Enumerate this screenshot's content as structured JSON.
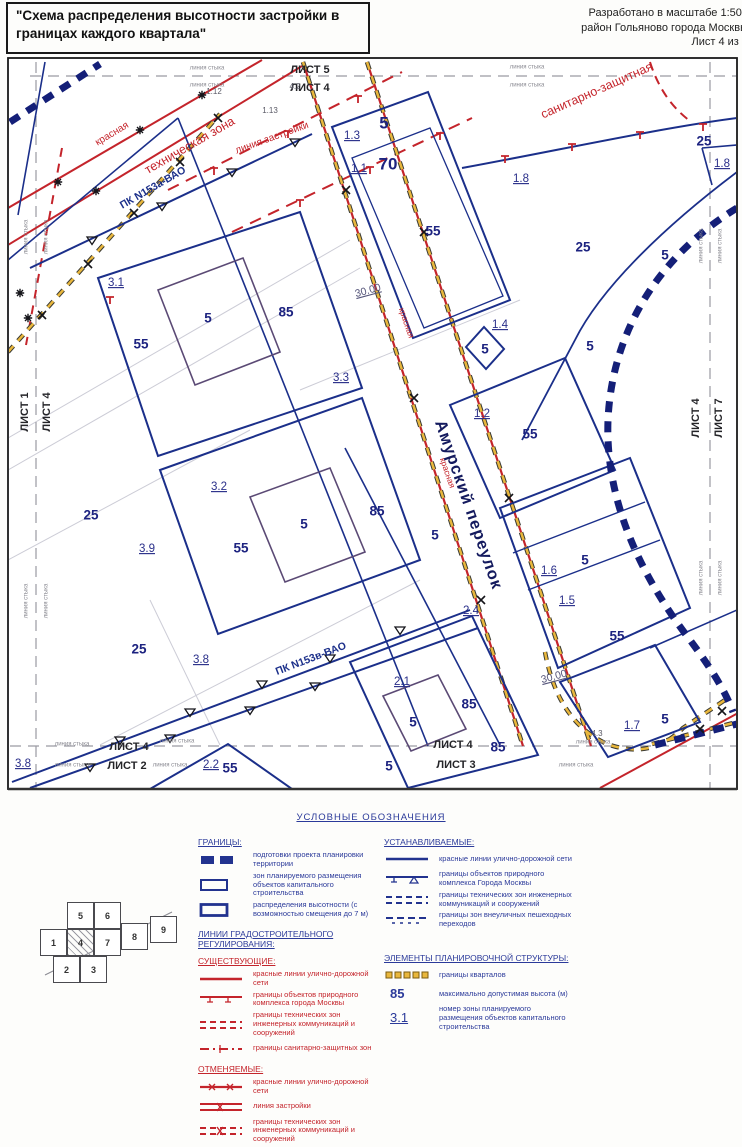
{
  "header": {
    "title": "\"Схема распределения высотности застройки в границах каждого квартала\"",
    "right_lines": [
      "Разработано в масштабе 1:500",
      "район Гольяново города Москвы",
      "Лист 4 из 9"
    ]
  },
  "map": {
    "labels": [
      {
        "t": "ЛИСТ 5",
        "x": 310,
        "y": 70,
        "c": "s"
      },
      {
        "t": "ЛИСТ 4",
        "x": 310,
        "y": 88,
        "c": "s"
      },
      {
        "t": "линия стыка",
        "x": 207,
        "y": 68,
        "c": "ss"
      },
      {
        "t": "линия стыка",
        "x": 207,
        "y": 85,
        "c": "ss"
      },
      {
        "t": "линия стыка",
        "x": 527,
        "y": 67,
        "c": "ss"
      },
      {
        "t": "линия стыка",
        "x": 527,
        "y": 85,
        "c": "ss"
      },
      {
        "t": "1.12",
        "x": 214,
        "y": 92,
        "c": "zs"
      },
      {
        "t": "4.2",
        "x": 295,
        "y": 87,
        "c": "zs"
      },
      {
        "t": "1.13",
        "x": 270,
        "y": 111,
        "c": "zs"
      },
      {
        "t": "ЛИСТ 1",
        "x": 25,
        "y": 412,
        "r": -90,
        "c": "s"
      },
      {
        "t": "ЛИСТ 4",
        "x": 47,
        "y": 412,
        "r": -90,
        "c": "s"
      },
      {
        "t": "линия стыка",
        "x": 26,
        "y": 237,
        "r": -90,
        "c": "ss"
      },
      {
        "t": "линия стыка",
        "x": 46,
        "y": 237,
        "r": -90,
        "c": "ss"
      },
      {
        "t": "линия стыка",
        "x": 26,
        "y": 601,
        "r": -90,
        "c": "ss"
      },
      {
        "t": "линия стыка",
        "x": 46,
        "y": 601,
        "r": -90,
        "c": "ss"
      },
      {
        "t": "ЛИСТ 4",
        "x": 696,
        "y": 418,
        "r": -90,
        "c": "s"
      },
      {
        "t": "ЛИСТ 7",
        "x": 719,
        "y": 418,
        "r": -90,
        "c": "s"
      },
      {
        "t": "линия стыка",
        "x": 701,
        "y": 246,
        "r": -90,
        "c": "ss"
      },
      {
        "t": "линия стыка",
        "x": 720,
        "y": 246,
        "r": -90,
        "c": "ss"
      },
      {
        "t": "линия стыка",
        "x": 701,
        "y": 578,
        "r": -90,
        "c": "ss"
      },
      {
        "t": "линия стыка",
        "x": 720,
        "y": 578,
        "r": -90,
        "c": "ss"
      },
      {
        "t": "ЛИСТ 4",
        "x": 129,
        "y": 747,
        "c": "s"
      },
      {
        "t": "ЛИСТ 2",
        "x": 127,
        "y": 766,
        "c": "s"
      },
      {
        "t": "линия стыка",
        "x": 72,
        "y": 744,
        "c": "ss"
      },
      {
        "t": "линия стыка",
        "x": 72,
        "y": 765,
        "c": "ss"
      },
      {
        "t": "линия стыка",
        "x": 177,
        "y": 741,
        "c": "ss"
      },
      {
        "t": "линия стыка",
        "x": 170,
        "y": 765,
        "c": "ss"
      },
      {
        "t": "ЛИСТ 4",
        "x": 453,
        "y": 745,
        "c": "s"
      },
      {
        "t": "ЛИСТ 3",
        "x": 456,
        "y": 765,
        "c": "s"
      },
      {
        "t": "линия стыка",
        "x": 593,
        "y": 742,
        "c": "ss"
      },
      {
        "t": "линия стыка",
        "x": 576,
        "y": 765,
        "c": "ss"
      },
      {
        "t": "1.3",
        "x": 352,
        "y": 136,
        "c": "z"
      },
      {
        "t": "5",
        "x": 384,
        "y": 124,
        "c": "hl"
      },
      {
        "t": "1.1",
        "x": 359,
        "y": 169,
        "c": "z"
      },
      {
        "t": "70",
        "x": 388,
        "y": 165,
        "c": "hl"
      },
      {
        "t": "55",
        "x": 433,
        "y": 232,
        "c": "h"
      },
      {
        "t": "1.8",
        "x": 521,
        "y": 179,
        "c": "z"
      },
      {
        "t": "25",
        "x": 583,
        "y": 248,
        "c": "h"
      },
      {
        "t": "25",
        "x": 704,
        "y": 142,
        "c": "h"
      },
      {
        "t": "1.8",
        "x": 722,
        "y": 164,
        "c": "z"
      },
      {
        "t": "5",
        "x": 665,
        "y": 256,
        "c": "h"
      },
      {
        "t": "1.4",
        "x": 500,
        "y": 325,
        "c": "z"
      },
      {
        "t": "5",
        "x": 485,
        "y": 350,
        "c": "h"
      },
      {
        "t": "5",
        "x": 590,
        "y": 347,
        "c": "h"
      },
      {
        "t": "1.2",
        "x": 482,
        "y": 414,
        "c": "z"
      },
      {
        "t": "55",
        "x": 530,
        "y": 435,
        "c": "h"
      },
      {
        "t": "3.1",
        "x": 116,
        "y": 283,
        "c": "z"
      },
      {
        "t": "55",
        "x": 141,
        "y": 345,
        "c": "h"
      },
      {
        "t": "5",
        "x": 208,
        "y": 319,
        "c": "h"
      },
      {
        "t": "85",
        "x": 286,
        "y": 313,
        "c": "h"
      },
      {
        "t": "3.3",
        "x": 341,
        "y": 378,
        "c": "z"
      },
      {
        "t": "30.00",
        "x": 368,
        "y": 291,
        "r": -15,
        "c": "d"
      },
      {
        "t": "25",
        "x": 91,
        "y": 516,
        "c": "h"
      },
      {
        "t": "3.2",
        "x": 219,
        "y": 487,
        "c": "z"
      },
      {
        "t": "55",
        "x": 241,
        "y": 549,
        "c": "h"
      },
      {
        "t": "5",
        "x": 304,
        "y": 525,
        "c": "h"
      },
      {
        "t": "85",
        "x": 377,
        "y": 512,
        "c": "h"
      },
      {
        "t": "3.9",
        "x": 147,
        "y": 549,
        "c": "z"
      },
      {
        "t": "25",
        "x": 139,
        "y": 650,
        "c": "h"
      },
      {
        "t": "3.8",
        "x": 201,
        "y": 660,
        "c": "z"
      },
      {
        "t": "5",
        "x": 435,
        "y": 536,
        "c": "h"
      },
      {
        "t": "2.4",
        "x": 471,
        "y": 611,
        "c": "z"
      },
      {
        "t": "1.6",
        "x": 549,
        "y": 571,
        "c": "z"
      },
      {
        "t": "5",
        "x": 585,
        "y": 561,
        "c": "h"
      },
      {
        "t": "1.5",
        "x": 567,
        "y": 601,
        "c": "z"
      },
      {
        "t": "55",
        "x": 617,
        "y": 637,
        "c": "h"
      },
      {
        "t": "30.00",
        "x": 554,
        "y": 677,
        "r": -15,
        "c": "d"
      },
      {
        "t": "2.1",
        "x": 402,
        "y": 682,
        "c": "z"
      },
      {
        "t": "5",
        "x": 413,
        "y": 723,
        "c": "h"
      },
      {
        "t": "85",
        "x": 469,
        "y": 705,
        "c": "h"
      },
      {
        "t": "85",
        "x": 498,
        "y": 748,
        "c": "h"
      },
      {
        "t": "1.7",
        "x": 632,
        "y": 726,
        "c": "z"
      },
      {
        "t": "5",
        "x": 665,
        "y": 720,
        "c": "h"
      },
      {
        "t": "4.3",
        "x": 597,
        "y": 734,
        "c": "zs"
      },
      {
        "t": "2.2",
        "x": 211,
        "y": 765,
        "c": "z"
      },
      {
        "t": "55",
        "x": 230,
        "y": 769,
        "c": "h"
      },
      {
        "t": "5",
        "x": 389,
        "y": 767,
        "c": "h"
      },
      {
        "t": "3.8",
        "x": 23,
        "y": 764,
        "c": "z"
      },
      {
        "t": "красная",
        "x": 112,
        "y": 134,
        "r": -31,
        "c": "r"
      },
      {
        "t": "техническая зона",
        "x": 190,
        "y": 146,
        "r": -30,
        "c": "rl"
      },
      {
        "t": "линия застройки",
        "x": 272,
        "y": 138,
        "r": -20,
        "c": "r"
      },
      {
        "t": "санитарно-защитная",
        "x": 597,
        "y": 91,
        "r": -24,
        "c": "rl"
      },
      {
        "t": "ПК N153а-ВАО",
        "x": 153,
        "y": 188,
        "r": -30,
        "c": "n"
      },
      {
        "t": "ПК N153в-ВАО",
        "x": 311,
        "y": 659,
        "r": -21,
        "c": "n"
      },
      {
        "t": "красная",
        "x": 406,
        "y": 323,
        "r": 71,
        "c": "rs"
      },
      {
        "t": "красная",
        "x": 447,
        "y": 473,
        "r": 71,
        "c": "rs"
      },
      {
        "t": "Амурский переулок",
        "x": 468,
        "y": 505,
        "r": 71,
        "c": "st"
      }
    ],
    "markers": [
      {
        "t": "x",
        "x": 42,
        "y": 315
      },
      {
        "t": "x",
        "x": 88,
        "y": 264
      },
      {
        "t": "x",
        "x": 134,
        "y": 213
      },
      {
        "t": "x",
        "x": 180,
        "y": 162
      },
      {
        "t": "x",
        "x": 218,
        "y": 118
      },
      {
        "t": "x",
        "x": 346,
        "y": 190
      },
      {
        "t": "x",
        "x": 414,
        "y": 398
      },
      {
        "t": "x",
        "x": 481,
        "y": 600
      },
      {
        "t": "x",
        "x": 424,
        "y": 232
      },
      {
        "t": "x",
        "x": 509,
        "y": 498
      },
      {
        "t": "x",
        "x": 700,
        "y": 729
      },
      {
        "t": "x",
        "x": 722,
        "y": 711
      },
      {
        "t": "star",
        "x": 58,
        "y": 182
      },
      {
        "t": "star",
        "x": 140,
        "y": 130
      },
      {
        "t": "star",
        "x": 202,
        "y": 95
      },
      {
        "t": "star",
        "x": 96,
        "y": 191
      },
      {
        "t": "star",
        "x": 20,
        "y": 293
      },
      {
        "t": "star",
        "x": 28,
        "y": 318
      },
      {
        "t": "tri",
        "x": 92,
        "y": 240
      },
      {
        "t": "tri",
        "x": 162,
        "y": 206
      },
      {
        "t": "tri",
        "x": 232,
        "y": 172
      },
      {
        "t": "tri",
        "x": 295,
        "y": 142
      },
      {
        "t": "tri",
        "x": 120,
        "y": 740
      },
      {
        "t": "tri",
        "x": 190,
        "y": 712
      },
      {
        "t": "tri",
        "x": 262,
        "y": 684
      },
      {
        "t": "tri",
        "x": 330,
        "y": 658
      },
      {
        "t": "tri",
        "x": 400,
        "y": 630
      },
      {
        "t": "tri",
        "x": 90,
        "y": 767
      },
      {
        "t": "tri",
        "x": 170,
        "y": 738
      },
      {
        "t": "tri",
        "x": 250,
        "y": 710
      },
      {
        "t": "tri",
        "x": 315,
        "y": 686
      },
      {
        "t": "tred",
        "x": 505,
        "y": 156
      },
      {
        "t": "tred",
        "x": 572,
        "y": 144
      },
      {
        "t": "tred",
        "x": 640,
        "y": 132
      },
      {
        "t": "tred",
        "x": 703,
        "y": 124
      },
      {
        "t": "tred",
        "x": 214,
        "y": 168
      },
      {
        "t": "tred",
        "x": 288,
        "y": 131
      },
      {
        "t": "tred",
        "x": 358,
        "y": 96
      },
      {
        "t": "tred",
        "x": 300,
        "y": 200
      },
      {
        "t": "tred",
        "x": 370,
        "y": 167
      },
      {
        "t": "tred",
        "x": 440,
        "y": 133
      },
      {
        "t": "tred",
        "x": 110,
        "y": 297
      }
    ]
  },
  "legend": {
    "header": "УСЛОВНЫЕ ОБОЗНАЧЕНИЯ",
    "left": {
      "granitsy": {
        "title": "ГРАНИЦЫ:",
        "items": [
          {
            "sym": "prep",
            "label": "подготовки проекта планировки территории"
          },
          {
            "sym": "zrect",
            "label": "зон планируемого размещения объектов капитального строительства"
          },
          {
            "sym": "hrect",
            "label": "распределения высотности (с возможностью смещения до 7 м)"
          }
        ]
      },
      "lines_title": "ЛИНИИ ГРАДОСТРОИТЕЛЬНОГО РЕГУЛИРОВАНИЯ:",
      "existing": {
        "title": "СУЩЕСТВУЮЩИЕ:",
        "items": [
          {
            "sym": "red-line",
            "label": "красные линии улично-дорожной сети"
          },
          {
            "sym": "red-opk",
            "label": "границы объектов природного комплекса города Москвы"
          },
          {
            "sym": "red-tech",
            "label": "границы технических зон инженерных коммуникаций и сооружений"
          },
          {
            "sym": "red-san",
            "label": "границы санитарно-защитных зон"
          }
        ]
      },
      "cancelled": {
        "title": "ОТМЕНЯЕМЫЕ:",
        "items": [
          {
            "sym": "red-line-x",
            "label": "красные линии улично-дорожной сети"
          },
          {
            "sym": "red-bld-x",
            "label": "линия застройки"
          },
          {
            "sym": "red-tech-x",
            "label": "границы технических зон инженерных коммуникаций и сооружений"
          }
        ]
      }
    },
    "right": {
      "established": {
        "title": "УСТАНАВЛИВАЕМЫЕ:",
        "items": [
          {
            "sym": "blue-line",
            "label": "красные линии улично-дорожной сети"
          },
          {
            "sym": "blue-opk",
            "label": "границы объектов природного комплекса Города Москвы"
          },
          {
            "sym": "blue-tech",
            "label": "границы технических зон инженерных коммуникаций и сооружений"
          },
          {
            "sym": "blue-ped",
            "label": "границы зон внеуличных пешеходных переходов"
          }
        ]
      },
      "elements": {
        "title": "ЭЛЕМЕНТЫ ПЛАНИРОВОЧНОЙ СТРУКТУРЫ:",
        "items": [
          {
            "sym": "quarter",
            "label": "границы кварталов"
          },
          {
            "sym": "text",
            "text": "85",
            "label": "максимально допустимая высота (м)"
          },
          {
            "sym": "text-u",
            "text": "3.1",
            "label": "номер зоны планируемого размещения объектов капитального строительства"
          }
        ]
      }
    }
  },
  "sheet_index": {
    "current": "4",
    "cells": [
      {
        "n": "1",
        "x": 40,
        "y": 929
      },
      {
        "n": "4",
        "x": 67,
        "y": 929
      },
      {
        "n": "7",
        "x": 94,
        "y": 929
      },
      {
        "n": "5",
        "x": 67,
        "y": 902
      },
      {
        "n": "6",
        "x": 94,
        "y": 902
      },
      {
        "n": "8",
        "x": 121,
        "y": 923
      },
      {
        "n": "9",
        "x": 150,
        "y": 916
      },
      {
        "n": "2",
        "x": 53,
        "y": 956
      },
      {
        "n": "3",
        "x": 80,
        "y": 956
      }
    ]
  }
}
